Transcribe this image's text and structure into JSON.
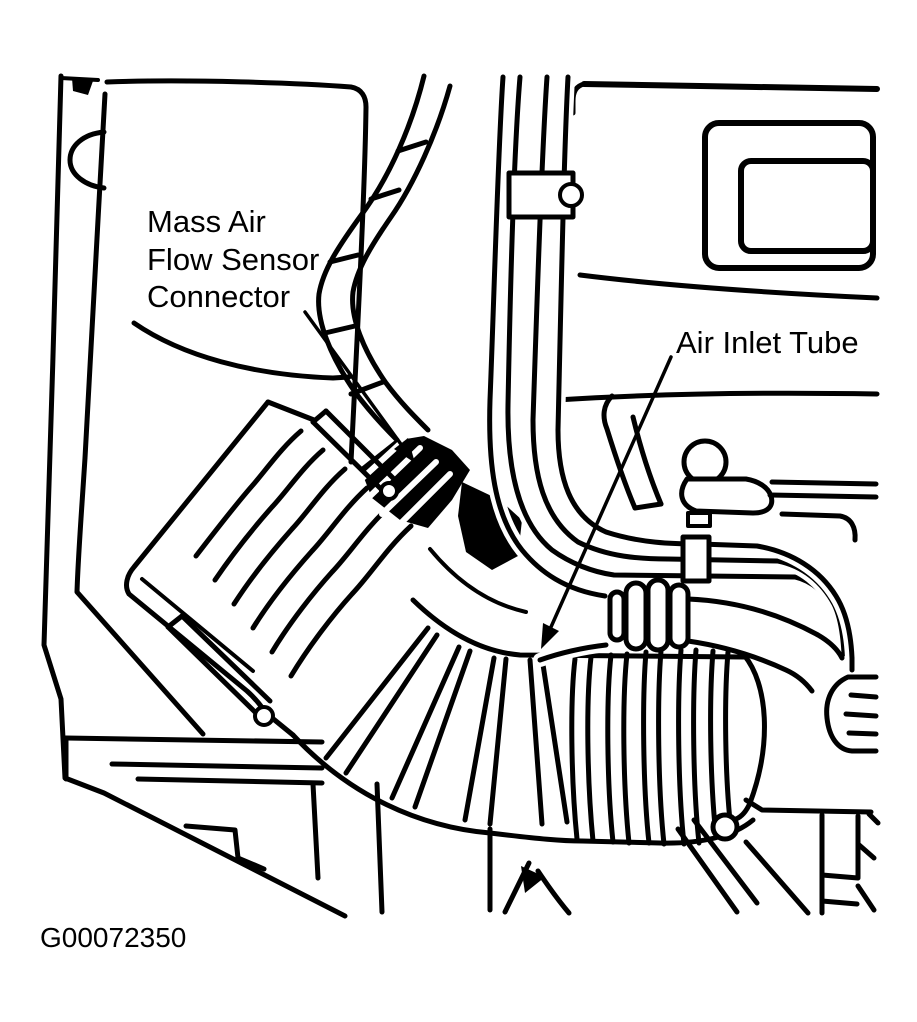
{
  "figure": {
    "type": "engine-bay-line-drawing",
    "labels": {
      "maf_connector": {
        "line1": "Mass Air",
        "line2": "Flow Sensor",
        "line3": "Connector"
      },
      "air_inlet_tube": "Air Inlet Tube"
    },
    "figure_code": "G00072350",
    "colors": {
      "line": "#000000",
      "background": "#ffffff"
    }
  }
}
